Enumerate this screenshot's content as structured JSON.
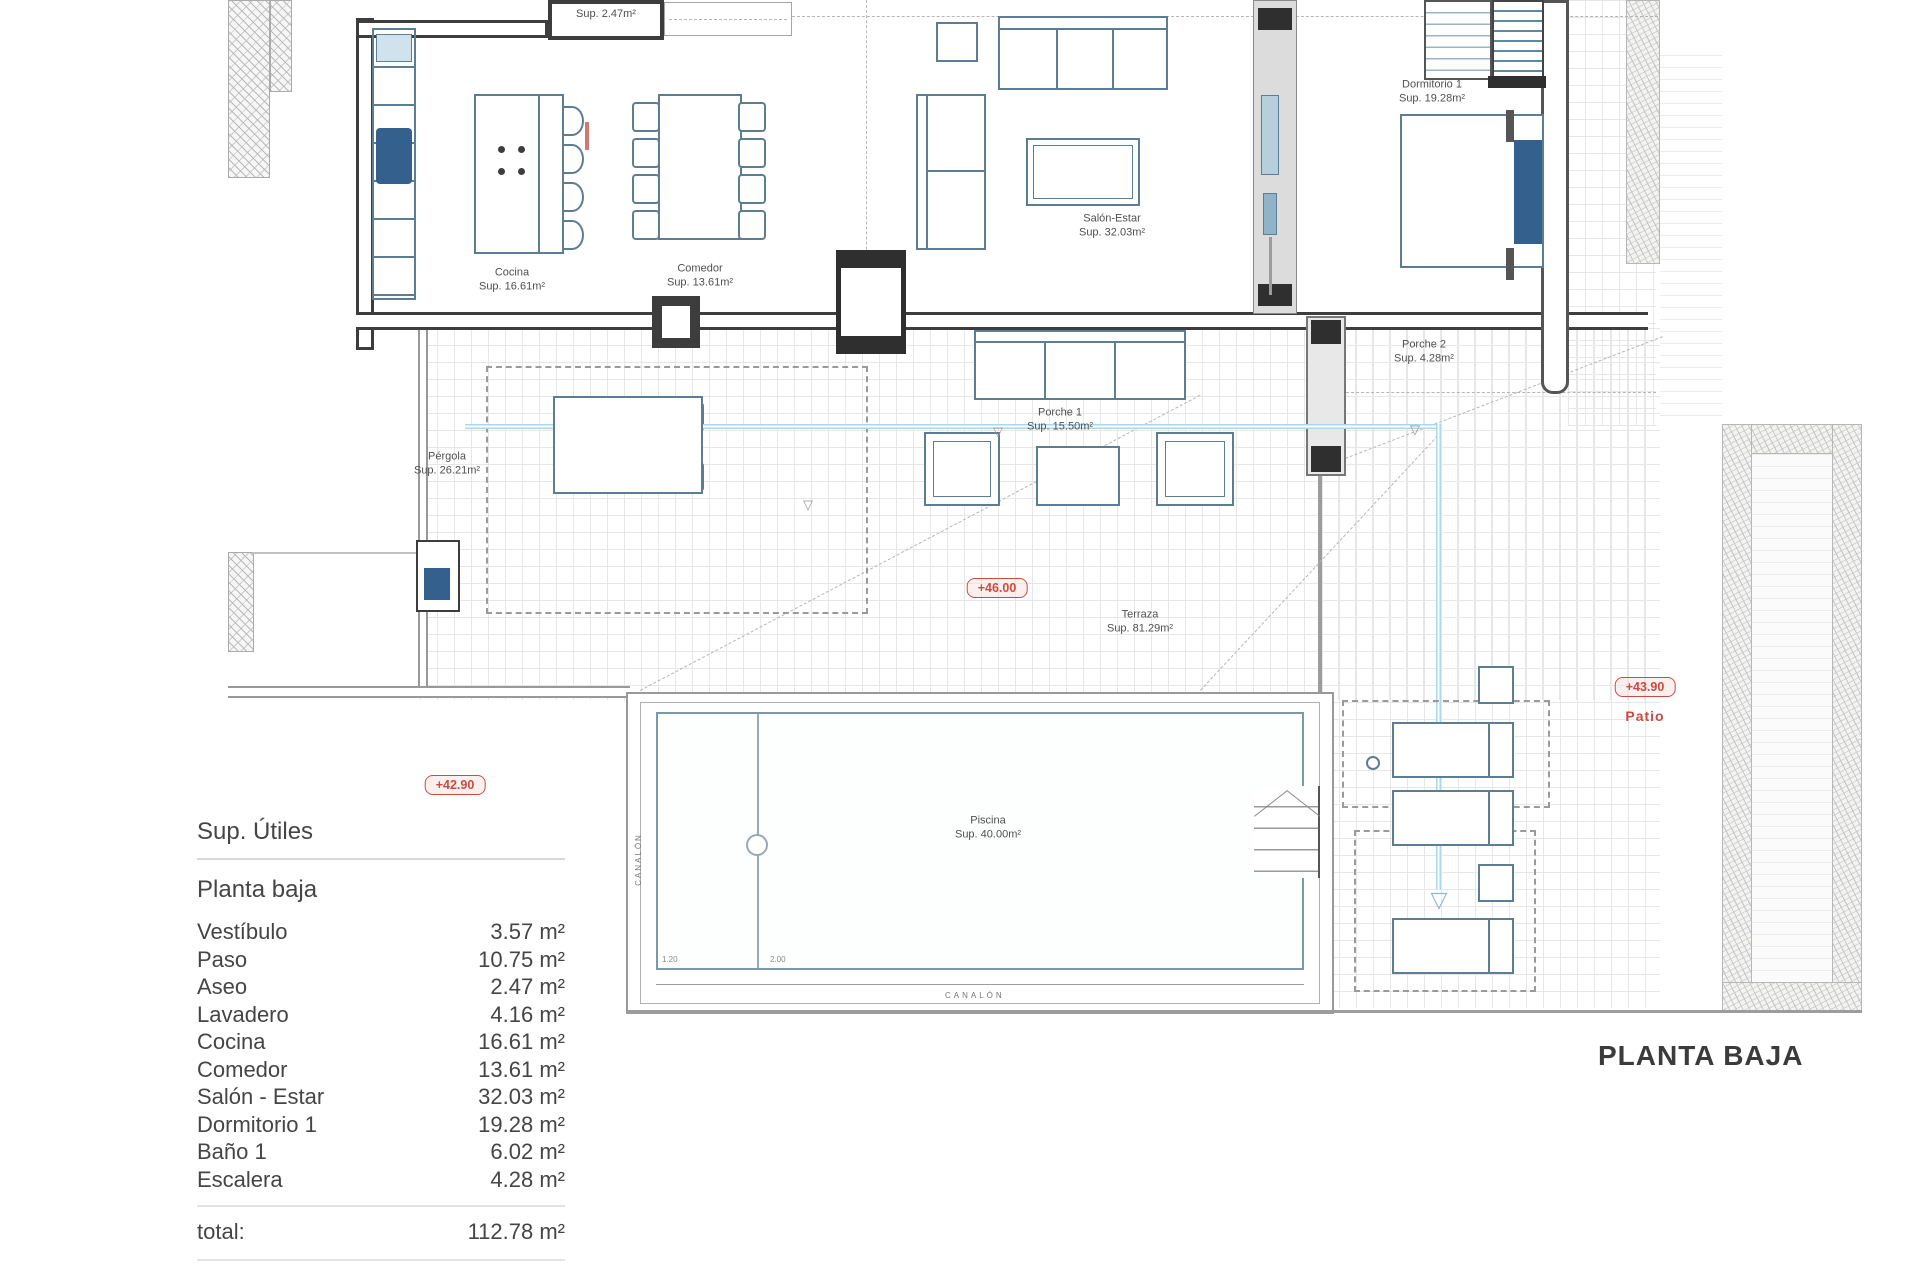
{
  "title_block": {
    "drawing_title": "PLANTA BAJA"
  },
  "plan": {
    "labels": {
      "aseo": {
        "sup": "Sup. 2.47m²"
      },
      "cocina": {
        "name": "Cocina",
        "sup": "Sup. 16.61m²"
      },
      "comedor": {
        "name": "Comedor",
        "sup": "Sup. 13.61m²"
      },
      "salon": {
        "name": "Salón-Estar",
        "sup": "Sup. 32.03m²"
      },
      "dormitorio": {
        "name": "Dormitorio 1",
        "sup": "Sup. 19.28m²"
      },
      "porche1": {
        "name": "Porche 1",
        "sup": "Sup. 15.50m²"
      },
      "porche2": {
        "name": "Porche 2",
        "sup": "Sup. 4.28m²"
      },
      "pergola": {
        "name": "Pérgola",
        "sup": "Sup. 26.21m²"
      },
      "terraza": {
        "name": "Terraza",
        "sup": "Sup. 81.29m²"
      },
      "piscina": {
        "name": "Piscina",
        "sup": "Sup. 40.00m²"
      }
    },
    "levels": {
      "terrace": "+46.00",
      "lower": "+42.90",
      "patio_level": "+43.90",
      "patio_name": "Patio"
    },
    "annotations": {
      "canalon_vertical": "CANALÓN",
      "canalon_horizontal": "CANALÓN",
      "pool_depth_1": "1.20",
      "pool_depth_2": "2.00",
      "level_marker_glyph": "▽"
    },
    "colors": {
      "accent_red": "#cb4a42",
      "furniture_line": "#5d7d93",
      "fill_blue": "#33608d",
      "pipe_blue": "#a9d8ea",
      "wall_dark": "#3d3d3d"
    }
  },
  "summary_table": {
    "header": "Sup. Útiles",
    "section": "Planta baja",
    "rows": [
      {
        "label": "Vestíbulo",
        "value": "3.57 m²"
      },
      {
        "label": "Paso",
        "value": "10.75 m²"
      },
      {
        "label": "Aseo",
        "value": "2.47 m²"
      },
      {
        "label": "Lavadero",
        "value": "4.16 m²"
      },
      {
        "label": "Cocina",
        "value": "16.61 m²"
      },
      {
        "label": "Comedor",
        "value": "13.61 m²"
      },
      {
        "label": "Salón - Estar",
        "value": "32.03 m²"
      },
      {
        "label": "Dormitorio 1",
        "value": "19.28 m²"
      },
      {
        "label": "Baño 1",
        "value": "6.02 m²"
      },
      {
        "label": "Escalera",
        "value": "4.28 m²"
      }
    ],
    "total_label": "total:",
    "total_value": "112.78 m²"
  }
}
